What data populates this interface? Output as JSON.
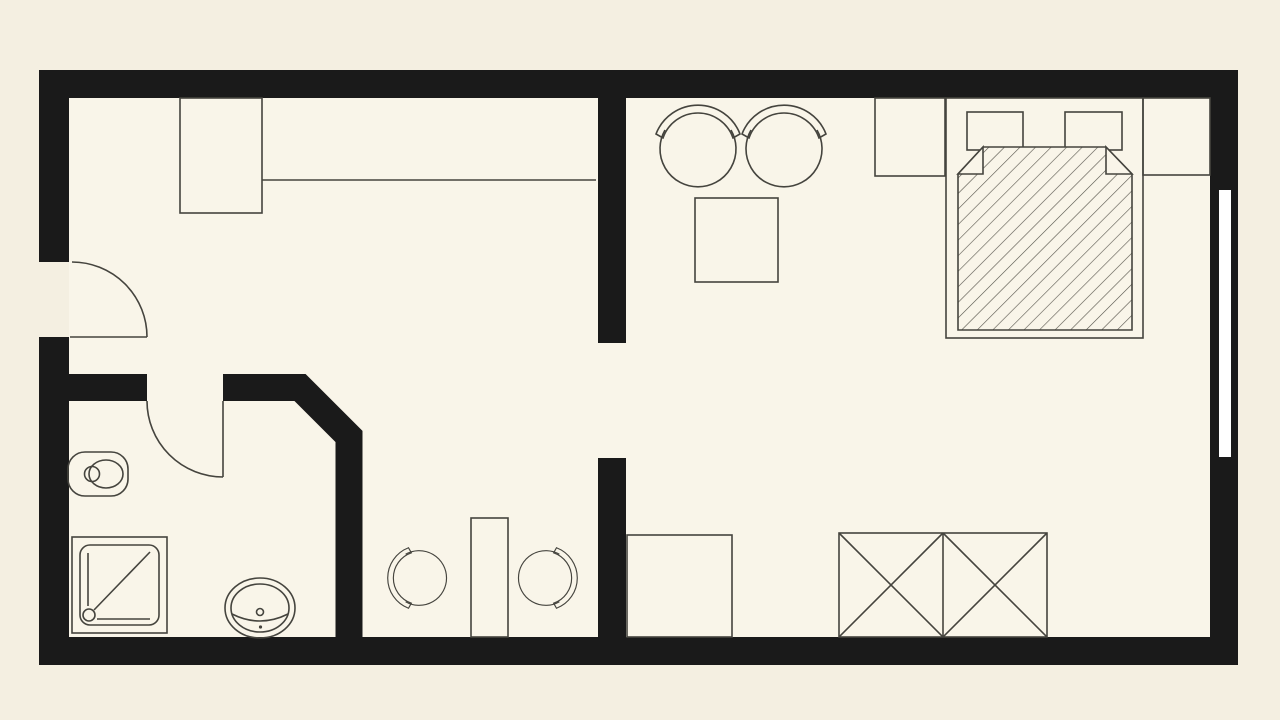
{
  "canvas": {
    "width": 1280,
    "height": 720,
    "bg_color": "#f4efe1",
    "floor_color": "#f9f5e9",
    "wall_color": "#1a1a1a",
    "line_color": "#45443e",
    "window_color": "#ffffff"
  },
  "hatch": {
    "size": 11,
    "angle": 45,
    "line_color": "#55534a",
    "line_width": 1.2
  },
  "symbols": {
    "chair": {
      "back_path": "M -42,-16 A 45,45 0 0 1 42,-16 L 35,-12 A 37,37 0 0 0 -35,-12 Z",
      "seat_path": "M -33,-20 A 38,38 0 1 0 33,-20"
    }
  },
  "elements": [
    {
      "name": "floor-area",
      "interactable": "false",
      "tag": "rect",
      "cls": "floor",
      "attrs": {
        "x": 69,
        "y": 98,
        "width": 1141,
        "height": 539
      }
    },
    {
      "name": "wall-top",
      "interactable": "false",
      "tag": "rect",
      "cls": "wall",
      "attrs": {
        "x": 39,
        "y": 70,
        "width": 1199,
        "height": 28
      }
    },
    {
      "name": "wall-bottom",
      "interactable": "false",
      "tag": "rect",
      "cls": "wall",
      "attrs": {
        "x": 39,
        "y": 637,
        "width": 1199,
        "height": 28
      }
    },
    {
      "name": "wall-left-upper",
      "interactable": "false",
      "tag": "rect",
      "cls": "wall",
      "attrs": {
        "x": 39,
        "y": 70,
        "width": 30,
        "height": 192
      }
    },
    {
      "name": "wall-left-lower",
      "interactable": "false",
      "tag": "rect",
      "cls": "wall",
      "attrs": {
        "x": 39,
        "y": 337,
        "width": 30,
        "height": 328
      }
    },
    {
      "name": "wall-right",
      "interactable": "false",
      "tag": "rect",
      "cls": "wall",
      "attrs": {
        "x": 1210,
        "y": 70,
        "width": 28,
        "height": 595
      }
    },
    {
      "name": "window",
      "interactable": "false",
      "tag": "rect",
      "cls": "win",
      "attrs": {
        "x": 1219,
        "y": 190,
        "width": 12,
        "height": 267
      }
    },
    {
      "name": "wall-bathroom-entry",
      "interactable": "false",
      "tag": "rect",
      "cls": "wall",
      "attrs": {
        "x": 69,
        "y": 374,
        "width": 78,
        "height": 27
      }
    },
    {
      "name": "wall-bathroom-corner",
      "interactable": "false",
      "tag": "path",
      "cls": "wallpath",
      "attrs": {
        "d": "M 223,387.5 H 300 L 349,436.5 V 650"
      }
    },
    {
      "name": "wall-divider-upper",
      "interactable": "false",
      "tag": "rect",
      "cls": "wall",
      "attrs": {
        "x": 598,
        "y": 95,
        "width": 28,
        "height": 248
      }
    },
    {
      "name": "wall-divider-lower",
      "interactable": "false",
      "tag": "rect",
      "cls": "wall",
      "attrs": {
        "x": 598,
        "y": 458,
        "width": 28,
        "height": 182
      }
    },
    {
      "name": "entrance-door-arc",
      "interactable": "false",
      "tag": "path",
      "cls": "stk",
      "attrs": {
        "d": "M 72,262 A 75,75 0 0 1 147,337",
        "fill": "none"
      }
    },
    {
      "name": "entrance-door-leaf",
      "interactable": "false",
      "tag": "line",
      "cls": "stk",
      "attrs": {
        "x1": 70,
        "y1": 337,
        "x2": 147,
        "y2": 337
      }
    },
    {
      "name": "bathroom-door-arc",
      "interactable": "false",
      "tag": "path",
      "cls": "stk",
      "attrs": {
        "d": "M 147,401 A 76,76 0 0 0 223,477",
        "fill": "none"
      }
    },
    {
      "name": "bathroom-door-leaf",
      "interactable": "false",
      "tag": "line",
      "cls": "stk",
      "attrs": {
        "x1": 223,
        "y1": 401,
        "x2": 223,
        "y2": 477
      }
    },
    {
      "name": "tall-cabinet",
      "interactable": "false",
      "tag": "rect",
      "cls": "stk",
      "attrs": {
        "x": 180,
        "y": 98,
        "width": 82,
        "height": 115,
        "fill": "none"
      }
    },
    {
      "name": "counter-line",
      "interactable": "false",
      "tag": "line",
      "cls": "stk",
      "attrs": {
        "x1": 262,
        "y1": 180,
        "x2": 596,
        "y2": 180
      }
    },
    {
      "name": "toilet",
      "interactable": "false",
      "tag": "rect",
      "cls": "stk",
      "attrs": {
        "x": 68,
        "y": 452,
        "width": 60,
        "height": 44,
        "rx": 17,
        "fill": "none"
      }
    },
    {
      "name": "toilet-seat",
      "interactable": "false",
      "tag": "ellipse",
      "cls": "stk",
      "attrs": {
        "cx": 106,
        "cy": 474,
        "rx": 17,
        "ry": 14,
        "fill": "none"
      }
    },
    {
      "name": "toilet-flush",
      "interactable": "false",
      "tag": "circle",
      "cls": "stk",
      "attrs": {
        "cx": 92,
        "cy": 474,
        "r": 7.5,
        "fill": "none"
      }
    },
    {
      "name": "shower-tray",
      "interactable": "false",
      "tag": "rect",
      "cls": "stk",
      "attrs": {
        "x": 72,
        "y": 537,
        "width": 95,
        "height": 96,
        "fill": "none"
      }
    },
    {
      "name": "shower-tray-inner",
      "interactable": "false",
      "tag": "rect",
      "cls": "stk",
      "attrs": {
        "x": 80,
        "y": 545,
        "width": 79,
        "height": 80,
        "rx": 10,
        "fill": "none"
      }
    },
    {
      "name": "shower-edge-line-vertical",
      "interactable": "false",
      "tag": "line",
      "cls": "stk",
      "attrs": {
        "x1": 88,
        "y1": 553,
        "x2": 88,
        "y2": 606
      }
    },
    {
      "name": "shower-diagonal-line",
      "interactable": "false",
      "tag": "line",
      "cls": "stk",
      "attrs": {
        "x1": 150,
        "y1": 552,
        "x2": 94,
        "y2": 610
      }
    },
    {
      "name": "shower-drain",
      "interactable": "false",
      "tag": "circle",
      "cls": "stk",
      "attrs": {
        "cx": 89,
        "cy": 615,
        "r": 6,
        "fill": "none"
      }
    },
    {
      "name": "shower-edge-line-horizontal",
      "interactable": "false",
      "tag": "line",
      "cls": "stk",
      "attrs": {
        "x1": 97,
        "y1": 619,
        "x2": 150,
        "y2": 619
      }
    },
    {
      "name": "washbasin-outer",
      "interactable": "false",
      "tag": "ellipse",
      "cls": "stk",
      "attrs": {
        "cx": 260,
        "cy": 608,
        "rx": 35,
        "ry": 30,
        "fill": "none"
      }
    },
    {
      "name": "washbasin-inner",
      "interactable": "false",
      "tag": "ellipse",
      "cls": "stk",
      "attrs": {
        "cx": 260,
        "cy": 608,
        "rx": 29,
        "ry": 24,
        "fill": "none"
      }
    },
    {
      "name": "washbasin-front-edge",
      "interactable": "false",
      "tag": "path",
      "cls": "stk",
      "attrs": {
        "d": "M 232,614 Q 260,628 288,614",
        "fill": "none"
      }
    },
    {
      "name": "washbasin-tap",
      "interactable": "false",
      "tag": "circle",
      "cls": "stk",
      "attrs": {
        "cx": 260,
        "cy": 612,
        "r": 3.5,
        "fill": "none"
      }
    },
    {
      "name": "washbasin-drain-dot",
      "interactable": "false",
      "tag": "circle",
      "attrs": {
        "cx": 260.5,
        "cy": 627,
        "r": 1.6,
        "fill": "#45443e"
      }
    },
    {
      "name": "desk",
      "interactable": "false",
      "tag": "rect",
      "cls": "stk",
      "attrs": {
        "x": 471,
        "y": 518,
        "width": 37,
        "height": 119,
        "fill": "none"
      }
    },
    {
      "name": "desk-chair-left",
      "interactable": "false",
      "tag": "use",
      "attrs": {
        "href": "#chair",
        "transform": "translate(420,578) rotate(-90) scale(0.72)"
      }
    },
    {
      "name": "desk-chair-right",
      "interactable": "false",
      "tag": "use",
      "attrs": {
        "href": "#chair",
        "transform": "translate(545,578) rotate(90) scale(0.72)"
      }
    },
    {
      "name": "storage-cabinet",
      "interactable": "false",
      "tag": "rect",
      "cls": "stk",
      "attrs": {
        "x": 627,
        "y": 535,
        "width": 105,
        "height": 102,
        "fill": "none"
      }
    },
    {
      "name": "lounge-chair-left",
      "interactable": "false",
      "tag": "use",
      "attrs": {
        "href": "#chair",
        "transform": "translate(698,150)"
      }
    },
    {
      "name": "lounge-chair-right",
      "interactable": "false",
      "tag": "use",
      "attrs": {
        "href": "#chair",
        "transform": "translate(784,150)"
      }
    },
    {
      "name": "side-table",
      "interactable": "false",
      "tag": "rect",
      "cls": "stk",
      "attrs": {
        "x": 695,
        "y": 198,
        "width": 83,
        "height": 84,
        "fill": "none"
      }
    },
    {
      "name": "wardrobe-outline",
      "interactable": "false",
      "tag": "rect",
      "cls": "stk",
      "attrs": {
        "x": 839,
        "y": 533,
        "width": 208,
        "height": 104,
        "fill": "none"
      }
    },
    {
      "name": "wardrobe-divider",
      "interactable": "false",
      "tag": "line",
      "cls": "stk",
      "attrs": {
        "x1": 943,
        "y1": 533,
        "x2": 943,
        "y2": 637
      }
    },
    {
      "name": "wardrobe-cross-left-a",
      "interactable": "false",
      "tag": "line",
      "cls": "stk",
      "attrs": {
        "x1": 839,
        "y1": 533,
        "x2": 943,
        "y2": 637
      }
    },
    {
      "name": "wardrobe-cross-left-b",
      "interactable": "false",
      "tag": "line",
      "cls": "stk",
      "attrs": {
        "x1": 943,
        "y1": 533,
        "x2": 839,
        "y2": 637
      }
    },
    {
      "name": "wardrobe-cross-right-a",
      "interactable": "false",
      "tag": "line",
      "cls": "stk",
      "attrs": {
        "x1": 943,
        "y1": 533,
        "x2": 1047,
        "y2": 637
      }
    },
    {
      "name": "wardrobe-cross-right-b",
      "interactable": "false",
      "tag": "line",
      "cls": "stk",
      "attrs": {
        "x1": 1047,
        "y1": 533,
        "x2": 943,
        "y2": 637
      }
    },
    {
      "name": "nightstand-left",
      "interactable": "false",
      "tag": "rect",
      "cls": "stk",
      "attrs": {
        "x": 875,
        "y": 98,
        "width": 70,
        "height": 78,
        "fill": "none"
      }
    },
    {
      "name": "nightstand-right",
      "interactable": "false",
      "tag": "rect",
      "cls": "stk",
      "attrs": {
        "x": 1143,
        "y": 98,
        "width": 67,
        "height": 77,
        "fill": "none"
      }
    },
    {
      "name": "bed-frame",
      "interactable": "false",
      "tag": "rect",
      "cls": "stk",
      "attrs": {
        "x": 946,
        "y": 98,
        "width": 197,
        "height": 240,
        "fill": "none"
      }
    },
    {
      "name": "pillow-left",
      "interactable": "false",
      "tag": "rect",
      "cls": "stk",
      "attrs": {
        "x": 967,
        "y": 112,
        "width": 56,
        "height": 38,
        "fill": "#f9f5e9"
      }
    },
    {
      "name": "pillow-right",
      "interactable": "false",
      "tag": "rect",
      "cls": "stk",
      "attrs": {
        "x": 1065,
        "y": 112,
        "width": 57,
        "height": 38,
        "fill": "#f9f5e9"
      }
    },
    {
      "name": "duvet",
      "interactable": "false",
      "tag": "polygon",
      "cls": "stk",
      "attrs": {
        "points": "983,147 1106,147 1132,174 1132,330 958,330 958,174",
        "fill": "url(#hatch)"
      }
    },
    {
      "name": "duvet-fold-left",
      "interactable": "false",
      "tag": "polygon",
      "cls": "stk",
      "attrs": {
        "points": "983,147 958,174 983,174",
        "fill": "#f9f5e9"
      }
    },
    {
      "name": "duvet-fold-right",
      "interactable": "false",
      "tag": "polygon",
      "cls": "stk",
      "attrs": {
        "points": "1106,147 1132,174 1106,174",
        "fill": "#f9f5e9"
      }
    }
  ]
}
